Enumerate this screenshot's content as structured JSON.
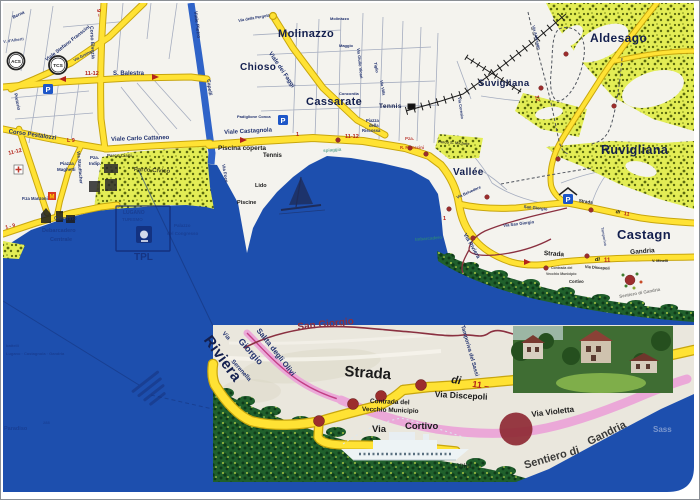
{
  "colors": {
    "lake": "#1d4fae",
    "river": "#2f63c8",
    "land": "#f4f3ee",
    "inset_land": "#eae7dd",
    "park_bg": "#e3ed55",
    "park_dot": "#5b6a0e",
    "dark_green": "#20602c",
    "dark_green_dot": "#0e3b19",
    "dark_green_fleck": "#cfe24a",
    "road_fill": "#ffe234",
    "road_casing": "#c8a60d",
    "pink": "#eba8d8",
    "magenta": "#c23f85",
    "maroon": "#8a3040",
    "dot_red": "#9c2d2d",
    "marker_red": "#b3231a",
    "street_text": "#20316e",
    "district_text": "#131f4e",
    "black_text": "#1b1b1b",
    "teal_text": "#2e8a74",
    "faint_blue": "#15307c",
    "light_blue_text": "#93a9d6",
    "parking_blue": "#1d56c8"
  },
  "icons": {
    "acs_label": "ACS",
    "tcs_label": "TCS",
    "parking_letter": "P",
    "migros_letter": "M"
  },
  "labels": [
    {
      "n": "street-berna",
      "t": "Berna",
      "x": 11,
      "y": 15,
      "fs": 4.5,
      "c": "st",
      "r": -25
    },
    {
      "n": "street-dalberti",
      "t": "V. d'Alberti",
      "x": 2,
      "y": 39,
      "fs": 4,
      "c": "st",
      "r": -8,
      "o": 0.85
    },
    {
      "n": "street-pretorio",
      "t": "Pretorio",
      "x": 16,
      "y": 92,
      "fs": 4.5,
      "c": "st",
      "r": 78
    },
    {
      "n": "street-corso-elvezia",
      "t": "Corso Elvezia",
      "x": 92,
      "y": 25,
      "fs": 5,
      "c": "st",
      "r": 87
    },
    {
      "n": "route-9-elvezia",
      "t": "9 –",
      "x": 99,
      "y": 8,
      "fs": 5.5,
      "c": "rd",
      "r": 87
    },
    {
      "n": "street-viale-franscini",
      "t": "Viale Stefano Franscini",
      "x": 44,
      "y": 58,
      "fs": 5,
      "c": "st",
      "r": -38
    },
    {
      "n": "street-greina",
      "t": "Via Greina",
      "x": 72,
      "y": 58,
      "fs": 4,
      "c": "st",
      "r": -28
    },
    {
      "n": "route-1112-balestra",
      "t": "11-12",
      "x": 84,
      "y": 71,
      "fs": 5.5,
      "c": "rd"
    },
    {
      "n": "street-balestra",
      "t": "S. Balestra",
      "x": 112,
      "y": 70,
      "fs": 6,
      "c": "st"
    },
    {
      "n": "route-l9",
      "t": "L 9",
      "x": 66,
      "y": 138,
      "fs": 5.5,
      "c": "rd"
    },
    {
      "n": "street-pestalozzi",
      "t": "Corso Pestalozzi",
      "x": 8,
      "y": 128,
      "fs": 6,
      "c": "st",
      "r": 8
    },
    {
      "n": "street-cattaneo",
      "t": "Viale Carlo Cattaneo",
      "x": 110,
      "y": 136,
      "fs": 6,
      "c": "st",
      "r": -2
    },
    {
      "n": "street-stauffacher",
      "t": "Via Stauffacher",
      "x": 79,
      "y": 150,
      "fs": 4.5,
      "c": "st",
      "r": 85
    },
    {
      "n": "place-maghetti-1",
      "t": "Piazza",
      "x": 59,
      "y": 161,
      "fs": 4.5,
      "c": "st"
    },
    {
      "n": "place-maghetti-2",
      "t": "Maghetti",
      "x": 56,
      "y": 167,
      "fs": 4.5,
      "c": "st"
    },
    {
      "n": "place-indipendenza-1",
      "t": "Pza.",
      "x": 89,
      "y": 155,
      "fs": 4.5,
      "c": "st"
    },
    {
      "n": "place-indipendenza-2",
      "t": "Indip.",
      "x": 88,
      "y": 161,
      "fs": 4.5,
      "c": "st"
    },
    {
      "n": "place-manzoni",
      "t": "P.za Manzoni",
      "x": 21,
      "y": 196,
      "fs": 4.2,
      "c": "st"
    },
    {
      "n": "route-1112-left",
      "t": "11-12",
      "x": 7,
      "y": 151,
      "fs": 5.5,
      "c": "rd",
      "r": -14
    },
    {
      "n": "route-19-coast",
      "t": "1 - 9",
      "x": 4,
      "y": 225,
      "fs": 5,
      "c": "rd",
      "r": -14
    },
    {
      "n": "street-viale-pietro",
      "t": "Viale Pietro",
      "x": 196,
      "y": 10,
      "fs": 5,
      "c": "st",
      "r": 83
    },
    {
      "n": "street-capelli",
      "t": "Capelli",
      "x": 209,
      "y": 78,
      "fs": 5,
      "c": "st",
      "r": 83
    },
    {
      "n": "place-parco-ciani",
      "t": "Parco Ciani",
      "x": 106,
      "y": 153,
      "fs": 4.5,
      "c": "bk",
      "o": 0.8
    },
    {
      "n": "place-parco-civico",
      "t": "Parco Civico",
      "x": 133,
      "y": 166,
      "fs": 6,
      "c": "bk",
      "r": 3,
      "o": 0.8
    },
    {
      "n": "street-pergola",
      "t": "Via della Pergola",
      "x": 237,
      "y": 18,
      "fs": 4,
      "c": "st",
      "r": -10
    },
    {
      "n": "district-chioso",
      "t": "Chioso",
      "x": 239,
      "y": 62,
      "fs": 10,
      "c": "di"
    },
    {
      "n": "district-molinazzo",
      "t": "Molinazzo",
      "x": 277,
      "y": 28,
      "fs": 11,
      "c": "di"
    },
    {
      "n": "street-molinazzo-sm",
      "t": "Molinazzo",
      "x": 329,
      "y": 16,
      "fs": 4,
      "c": "st"
    },
    {
      "n": "street-maggio",
      "t": "Maggio",
      "x": 338,
      "y": 43,
      "fs": 4,
      "c": "st"
    },
    {
      "n": "street-vicari",
      "t": "Via Giulio Vicari",
      "x": 359,
      "y": 47,
      "fs": 4,
      "c": "st",
      "r": 84
    },
    {
      "n": "street-tiglio",
      "t": "Tiglio",
      "x": 376,
      "y": 61,
      "fs": 4,
      "c": "st",
      "r": 80
    },
    {
      "n": "street-concordia",
      "t": "Concordia",
      "x": 338,
      "y": 91,
      "fs": 4,
      "c": "st"
    },
    {
      "n": "street-via-villa",
      "t": "Via Villa",
      "x": 382,
      "y": 79,
      "fs": 4,
      "c": "st",
      "r": 80
    },
    {
      "n": "district-cassarate",
      "t": "Cassarate",
      "x": 305,
      "y": 96,
      "fs": 11,
      "c": "di"
    },
    {
      "n": "place-tennis-nord",
      "t": "Tennis",
      "x": 378,
      "y": 103,
      "fs": 6.5,
      "c": "di"
    },
    {
      "n": "place-riscossa-1",
      "t": "Piazza",
      "x": 365,
      "y": 118,
      "fs": 4.2,
      "c": "st"
    },
    {
      "n": "place-riscossa-2",
      "t": "della",
      "x": 368,
      "y": 123,
      "fs": 4.2,
      "c": "st"
    },
    {
      "n": "place-riscossa-3",
      "t": "Riscossa",
      "x": 361,
      "y": 128,
      "fs": 4.2,
      "c": "st"
    },
    {
      "n": "place-franscini-1",
      "t": "Pza.",
      "x": 404,
      "y": 136,
      "fs": 4.5,
      "c": "rd",
      "o": 0.85
    },
    {
      "n": "place-franscini-2",
      "t": "R. Franscini",
      "x": 399,
      "y": 145,
      "fs": 4.2,
      "c": "rd",
      "o": 0.85
    },
    {
      "n": "street-faggi",
      "t": "Viale dei Faggi",
      "x": 271,
      "y": 50,
      "fs": 6,
      "c": "st",
      "r": 56
    },
    {
      "n": "street-viale-castagnola",
      "t": "Viale Castagnola",
      "x": 223,
      "y": 129,
      "fs": 6,
      "c": "st",
      "r": -3
    },
    {
      "n": "route-1-castagnola",
      "t": "1",
      "x": 295,
      "y": 132,
      "fs": 5.5,
      "c": "rd"
    },
    {
      "n": "route-1112-castagnola",
      "t": "11-12",
      "x": 344,
      "y": 134,
      "fs": 5.5,
      "c": "rd"
    },
    {
      "n": "place-conca",
      "t": "Padiglione Conca",
      "x": 236,
      "y": 114,
      "fs": 4,
      "c": "st"
    },
    {
      "n": "place-piscina-coperta",
      "t": "Piscina coperta",
      "x": 217,
      "y": 145,
      "fs": 6.5,
      "c": "bk"
    },
    {
      "n": "place-tennis-lido",
      "t": "Tennis",
      "x": 262,
      "y": 152,
      "fs": 6,
      "c": "bk"
    },
    {
      "n": "place-lido",
      "t": "Lido",
      "x": 254,
      "y": 183,
      "fs": 5.5,
      "c": "bk"
    },
    {
      "n": "place-piscine",
      "t": "Piscine",
      "x": 236,
      "y": 200,
      "fs": 5.5,
      "c": "bk"
    },
    {
      "n": "street-via-foce",
      "t": "Via Foce",
      "x": 224,
      "y": 163,
      "fs": 4.5,
      "c": "st",
      "r": 80
    },
    {
      "n": "district-aldesago",
      "t": "Aldesago",
      "x": 589,
      "y": 31,
      "fs": 12,
      "c": "di"
    },
    {
      "n": "district-suvigliana",
      "t": "Suvigliana",
      "x": 477,
      "y": 78,
      "fs": 9.5,
      "c": "di"
    },
    {
      "n": "district-ruvigliana",
      "t": "Ruvigliana",
      "x": 600,
      "y": 143,
      "fs": 12.5,
      "c": "di"
    },
    {
      "n": "street-via-aldesago",
      "t": "Via Aldesago",
      "x": 534,
      "y": 24,
      "fs": 4,
      "c": "st",
      "r": 76
    },
    {
      "n": "route-12-suvigliana",
      "t": "12",
      "x": 537,
      "y": 94,
      "fs": 5.5,
      "c": "rd",
      "r": 78
    },
    {
      "n": "street-via-ceresio",
      "t": "Via Ceresio",
      "x": 460,
      "y": 96,
      "fs": 4,
      "c": "st",
      "r": 82
    },
    {
      "n": "district-vallee",
      "t": "Vallée",
      "x": 452,
      "y": 167,
      "fs": 10,
      "c": "di"
    },
    {
      "n": "place-parco-michele",
      "t": "Parco S. Michele",
      "x": 437,
      "y": 139,
      "fs": 4,
      "c": "bk",
      "r": 4,
      "o": 0.85
    },
    {
      "n": "street-belvedere",
      "t": "Via Belvedere",
      "x": 455,
      "y": 195,
      "fs": 4,
      "c": "st",
      "r": -24
    },
    {
      "n": "street-san-giorgio-1",
      "t": "San Giorgio",
      "x": 523,
      "y": 204,
      "fs": 4.2,
      "c": "st",
      "r": 6
    },
    {
      "n": "street-san-giorgio-2",
      "t": "Via San Giorgio",
      "x": 502,
      "y": 223,
      "fs": 4.2,
      "c": "st",
      "r": -7
    },
    {
      "n": "street-via-riviera",
      "t": "Via Riviera",
      "x": 465,
      "y": 232,
      "fs": 5.5,
      "c": "st",
      "r": 60
    },
    {
      "n": "street-strada-upper",
      "t": "Strada",
      "x": 578,
      "y": 198,
      "fs": 4.5,
      "c": "bk",
      "r": 8
    },
    {
      "n": "street-di-upper",
      "t": "di",
      "x": 615,
      "y": 209,
      "fs": 5,
      "c": "it",
      "r": 10
    },
    {
      "n": "route-11-upper",
      "t": "11",
      "x": 623,
      "y": 211,
      "fs": 5.5,
      "c": "rd",
      "r": 10
    },
    {
      "n": "district-castagnola",
      "t": "Castagn",
      "x": 616,
      "y": 227,
      "fs": 13,
      "c": "di"
    },
    {
      "n": "street-tamporiva",
      "t": "Tamporiva",
      "x": 602,
      "y": 226,
      "fs": 3.8,
      "c": "st",
      "r": 80,
      "o": 0.8
    },
    {
      "n": "street-strada-lower",
      "t": "Strada",
      "x": 543,
      "y": 250,
      "fs": 6.5,
      "c": "bk",
      "r": 4
    },
    {
      "n": "street-di-lower",
      "t": "di",
      "x": 594,
      "y": 257,
      "fs": 5.5,
      "c": "it"
    },
    {
      "n": "route-11-lower",
      "t": "11",
      "x": 603,
      "y": 257,
      "fs": 6,
      "c": "rd"
    },
    {
      "n": "street-gandria-lower",
      "t": "Gandria",
      "x": 629,
      "y": 249,
      "fs": 6.5,
      "c": "bk",
      "r": -4
    },
    {
      "n": "street-discepoli-main",
      "t": "Via Discepoli",
      "x": 584,
      "y": 264,
      "fs": 4,
      "c": "bk",
      "r": 4
    },
    {
      "n": "street-minelli",
      "t": "V. Minelli",
      "x": 651,
      "y": 259,
      "fs": 3.8,
      "c": "bk"
    },
    {
      "n": "place-contrada-m1",
      "t": "Contrada del",
      "x": 550,
      "y": 266,
      "fs": 3.5,
      "c": "bk",
      "o": 0.8
    },
    {
      "n": "place-contrada-m2",
      "t": "Vecchio Municipio",
      "x": 545,
      "y": 272,
      "fs": 3.5,
      "c": "bk",
      "o": 0.8
    },
    {
      "n": "street-cortivo-main",
      "t": "Cortivo",
      "x": 568,
      "y": 279,
      "fs": 4.2,
      "c": "bk"
    },
    {
      "n": "street-sentiero-main",
      "t": "Sentiero di Gandria",
      "x": 618,
      "y": 294,
      "fs": 4.5,
      "c": "bk",
      "r": -10,
      "o": 0.55
    },
    {
      "n": "route-1-riviera",
      "t": "1",
      "x": 442,
      "y": 216,
      "fs": 5.5,
      "c": "rd"
    },
    {
      "n": "lake-giardino",
      "t": "Giardino",
      "x": 53,
      "y": 216,
      "fs": 5.5,
      "c": "ft",
      "o": 0.75
    },
    {
      "n": "lake-debarcadero-1",
      "t": "Debarcadero",
      "x": 41,
      "y": 228,
      "fs": 5.5,
      "c": "ft",
      "o": 0.6
    },
    {
      "n": "lake-debarcadero-2",
      "t": "Centrale",
      "x": 49,
      "y": 237,
      "fs": 5.5,
      "c": "ft",
      "o": 0.6
    },
    {
      "n": "lake-palazzo-1",
      "t": "Palazzo",
      "x": 173,
      "y": 223,
      "fs": 4.5,
      "c": "ft",
      "o": 0.5
    },
    {
      "n": "lake-palazzo-2",
      "t": "del Congresso",
      "x": 166,
      "y": 231,
      "fs": 4.5,
      "c": "ft",
      "o": 0.5
    },
    {
      "n": "lake-tpl",
      "t": "TPL",
      "x": 133,
      "y": 252,
      "fs": 10,
      "c": "ft",
      "o": 0.85
    },
    {
      "n": "lake-spiaggia",
      "t": "spiaggia",
      "x": 322,
      "y": 148,
      "fs": 4.5,
      "c": "tl",
      "r": -4,
      "o": 0.7
    },
    {
      "n": "lake-imbarcadero",
      "t": "Imbarcadero",
      "x": 414,
      "y": 237,
      "fs": 4.5,
      "c": "tl",
      "r": -5,
      "o": 0.85
    },
    {
      "n": "lake-battelli-1",
      "t": "battelli",
      "x": 5,
      "y": 343,
      "fs": 4,
      "c": "ft",
      "o": 0.55
    },
    {
      "n": "lake-battelli-2",
      "t": "Lugano · Castagnola · Gandria",
      "x": 5,
      "y": 351,
      "fs": 4,
      "c": "ft",
      "o": 0.55
    },
    {
      "n": "lake-paradiso",
      "t": "Paradiso",
      "x": 3,
      "y": 426,
      "fs": 5.5,
      "c": "ft",
      "o": 0.5
    },
    {
      "n": "lake-depth",
      "t": "288",
      "x": 42,
      "y": 420,
      "fs": 4,
      "c": "ft",
      "o": 0.45
    },
    {
      "n": "stamp-line-1",
      "t": "LUGANO",
      "x": 122,
      "y": 210,
      "fs": 5,
      "c": "ft",
      "o": 0.55
    },
    {
      "n": "stamp-line-2",
      "t": "TURISMO",
      "x": 121,
      "y": 217,
      "fs": 4.5,
      "c": "ft",
      "o": 0.45
    },
    {
      "n": "inset-riviera",
      "t": "Riviera",
      "x": 212,
      "y": 332,
      "fs": 15,
      "c": "di",
      "r": 54
    },
    {
      "n": "inset-via",
      "t": "Via",
      "x": 224,
      "y": 330,
      "fs": 6,
      "c": "st",
      "r": 48
    },
    {
      "n": "inset-giorgio",
      "t": "Giorgio",
      "x": 242,
      "y": 336,
      "fs": 9,
      "c": "st",
      "r": 48
    },
    {
      "n": "inset-salita",
      "t": "Salita degli Olivi",
      "x": 260,
      "y": 326,
      "fs": 7.5,
      "c": "st",
      "r": 52
    },
    {
      "n": "inset-serenella",
      "t": "Serenella",
      "x": 233,
      "y": 358,
      "fs": 6,
      "c": "st",
      "r": 48
    },
    {
      "n": "inset-san-giorgio",
      "t": "San Giorgio",
      "x": 296,
      "y": 322,
      "fs": 10,
      "c": "mr",
      "r": -6
    },
    {
      "n": "inset-strada",
      "t": "Strada",
      "x": 344,
      "y": 363,
      "fs": 15,
      "c": "bk",
      "r": 4
    },
    {
      "n": "inset-di",
      "t": "di",
      "x": 451,
      "y": 374,
      "fs": 11,
      "c": "it",
      "r": 8
    },
    {
      "n": "inset-11",
      "t": "11 –",
      "x": 472,
      "y": 379,
      "fs": 9,
      "c": "rd",
      "r": 8
    },
    {
      "n": "inset-contrada-1",
      "t": "Contrada del",
      "x": 369,
      "y": 398,
      "fs": 6.5,
      "c": "bk",
      "r": 2
    },
    {
      "n": "inset-contrada-2",
      "t": "Vecchio Municipio",
      "x": 361,
      "y": 406,
      "fs": 6.5,
      "c": "bk",
      "r": 2
    },
    {
      "n": "inset-via-cortivo-1",
      "t": "Via",
      "x": 371,
      "y": 424,
      "fs": 9.5,
      "c": "bk"
    },
    {
      "n": "inset-via-cortivo-2",
      "t": "Cortivo",
      "x": 404,
      "y": 421,
      "fs": 9.5,
      "c": "bk"
    },
    {
      "n": "inset-discepoli",
      "t": "Via Discepoli",
      "x": 434,
      "y": 389,
      "fs": 8.5,
      "c": "bk",
      "r": 3
    },
    {
      "n": "inset-violetta",
      "t": "Via Violetta",
      "x": 530,
      "y": 410,
      "fs": 8,
      "c": "bk",
      "r": -7
    },
    {
      "n": "inset-sentiero",
      "t": "Sentiero di",
      "x": 522,
      "y": 460,
      "fs": 11,
      "c": "bk",
      "r": -16,
      "o": 0.85
    },
    {
      "n": "inset-gandria",
      "t": "Gandria",
      "x": 585,
      "y": 437,
      "fs": 11,
      "c": "bk",
      "r": -26,
      "o": 0.85
    },
    {
      "n": "inset-sassi",
      "t": "Tamporiva del Sassi",
      "x": 463,
      "y": 324,
      "fs": 5.5,
      "c": "st",
      "r": 74
    },
    {
      "n": "inset-villa",
      "t": "Villa",
      "x": 456,
      "y": 462,
      "fs": 7,
      "c": "bk",
      "o": 0.55
    },
    {
      "n": "lake-sass",
      "t": "Sass",
      "x": 652,
      "y": 425,
      "fs": 8,
      "c": "lb",
      "o": 0.8
    }
  ]
}
